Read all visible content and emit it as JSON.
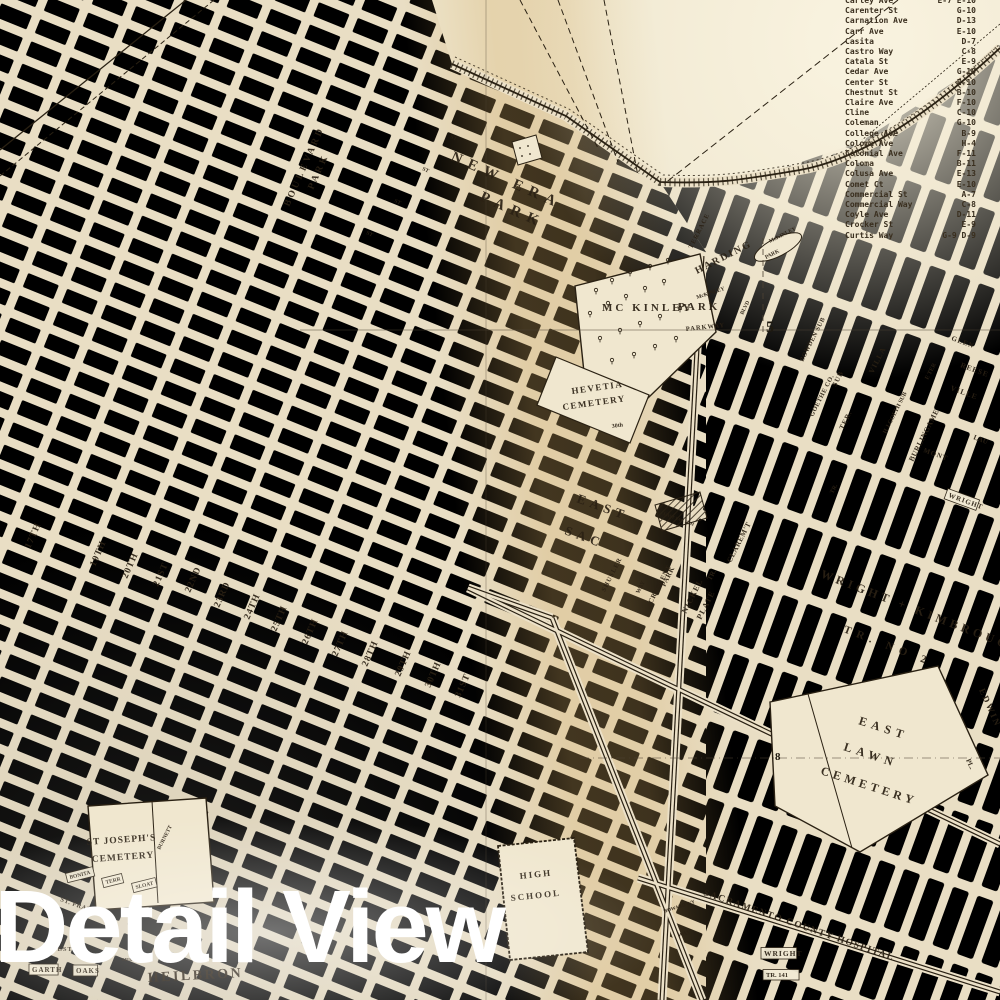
{
  "watermark": "Detail View",
  "street_index": {
    "rows": [
      {
        "name": "Carley Ave",
        "ref": "E-7 E-10"
      },
      {
        "name": "Carenter St",
        "ref": "G-10"
      },
      {
        "name": "Carnation Ave",
        "ref": "D-13"
      },
      {
        "name": "Carr Ave",
        "ref": "E-10"
      },
      {
        "name": "Casita",
        "ref": "D-7"
      },
      {
        "name": "Castro Way",
        "ref": "C-8"
      },
      {
        "name": "Catala St",
        "ref": "E-9"
      },
      {
        "name": "Cedar Ave",
        "ref": "G-10"
      },
      {
        "name": "Center St",
        "ref": "E-10"
      },
      {
        "name": "Chestnut St",
        "ref": "B-10"
      },
      {
        "name": "Claire Ave",
        "ref": "F-10"
      },
      {
        "name": "Cline",
        "ref": "C-10"
      },
      {
        "name": "Coleman",
        "ref": "G-10"
      },
      {
        "name": "College Ave",
        "ref": "B-9"
      },
      {
        "name": "Coloma Ave",
        "ref": "H-4"
      },
      {
        "name": "Colonial Ave",
        "ref": "F-11"
      },
      {
        "name": "Coloma",
        "ref": "B-11"
      },
      {
        "name": "Colusa Ave",
        "ref": "E-13"
      },
      {
        "name": "Comet Ct",
        "ref": "E-10"
      },
      {
        "name": "Commercial St",
        "ref": "A-7"
      },
      {
        "name": "Commercial Way",
        "ref": "C-8"
      },
      {
        "name": "Coyle Ave",
        "ref": "D-11"
      },
      {
        "name": "Crocker St",
        "ref": "E-9"
      },
      {
        "name": "Curtis Way",
        "ref": "G-9 D-9"
      }
    ]
  },
  "map": {
    "labels": [
      [
        "NEW ERA",
        450,
        160,
        24,
        15,
        7
      ],
      [
        "PARK",
        479,
        200,
        24,
        15,
        7
      ],
      [
        "BOULEVARD",
        289,
        207,
        -66,
        9.5,
        3
      ],
      [
        "PARK",
        313,
        190,
        -66,
        9.5,
        3
      ],
      [
        "MC KINLEY",
        602,
        311,
        0,
        11,
        3
      ],
      [
        "PARK",
        678,
        310,
        0,
        11,
        3
      ],
      [
        "HARDING",
        697,
        274,
        -27,
        10,
        2
      ],
      [
        "TERRACE",
        692,
        249,
        -63,
        6.5,
        1
      ],
      [
        "PARKWAY",
        686,
        331,
        -6,
        6.5,
        1
      ],
      [
        "McKINLEY",
        697,
        299,
        -18,
        5.5,
        0
      ],
      [
        "BLVD",
        743,
        315,
        -63,
        5.5,
        0
      ],
      [
        "McKINLEY",
        770,
        243,
        -27,
        5.5,
        0
      ],
      [
        "PARK",
        766,
        259,
        -27,
        5.5,
        0
      ],
      [
        "HEVETIA",
        572,
        394,
        -8,
        9,
        1.5
      ],
      [
        "CEMETERY",
        563,
        410,
        -8,
        9,
        1.5
      ],
      [
        "EAST",
        576,
        502,
        20,
        13,
        5
      ],
      [
        "SAC",
        564,
        534,
        20,
        13,
        5
      ],
      [
        "SHUSLER",
        605,
        592,
        -63,
        6.5,
        1
      ],
      [
        "WAY",
        639,
        594,
        -63,
        6,
        0
      ],
      [
        "CRESCENT",
        652,
        604,
        -63,
        7,
        0.5
      ],
      [
        "PARK",
        665,
        587,
        -63,
        7,
        0.5
      ],
      [
        "NICKEL",
        686,
        614,
        -63,
        8,
        1
      ],
      [
        "PLATE",
        701,
        620,
        -63,
        8,
        1
      ],
      [
        "TR.",
        711,
        581,
        -63,
        7,
        0
      ],
      [
        "CLAREM'T",
        731,
        563,
        -63,
        7.5,
        0.5
      ],
      [
        "EAST",
        858,
        724,
        18,
        12,
        5
      ],
      [
        "LAWN",
        843,
        750,
        18,
        12,
        5
      ],
      [
        "CEMETERY",
        820,
        774,
        18,
        12,
        4
      ],
      [
        "EDWIN",
        979,
        690,
        66,
        9,
        2
      ],
      [
        "PL.",
        966,
        760,
        66,
        7,
        0
      ],
      [
        "SACRAMENTO COUNTY HOSPITAL",
        703,
        895,
        19,
        9.5,
        1.5
      ],
      [
        "WRIGHT + KIMBROUGH",
        820,
        577,
        21,
        12,
        4
      ],
      [
        "TR. NO 2",
        843,
        632,
        21,
        11,
        6
      ],
      [
        "WRIGHT",
        948,
        497,
        20,
        7,
        1,
        1
      ],
      [
        "TR.",
        833,
        494,
        -63,
        6,
        0
      ],
      [
        "BOWDEN SUB",
        803,
        362,
        -63,
        6.5,
        0.5
      ],
      [
        "GOETHE CO.",
        813,
        417,
        -63,
        6.5,
        0.5
      ],
      [
        "SUB",
        836,
        387,
        -63,
        7,
        1
      ],
      [
        "TER.",
        843,
        430,
        -63,
        7,
        1
      ],
      [
        "VILLA",
        873,
        374,
        -63,
        7.5,
        1
      ],
      [
        "H.J.GOETH SUB",
        886,
        434,
        -63,
        6,
        0
      ],
      [
        "BURLINGAME",
        913,
        462,
        -63,
        7.5,
        0.5
      ],
      [
        "E TER",
        928,
        380,
        -63,
        6,
        0
      ],
      [
        "GLEN",
        951,
        340,
        20,
        7,
        1
      ],
      [
        "REESE",
        960,
        367,
        20,
        7.5,
        1
      ],
      [
        "VILLE",
        950,
        390,
        20,
        7.5,
        1
      ],
      [
        "MONT",
        923,
        452,
        20,
        7,
        1
      ],
      [
        "LAU",
        973,
        439,
        20,
        7,
        0
      ],
      [
        "ST JOSEPH'S",
        87,
        845,
        -4,
        9.5,
        1
      ],
      [
        "CEMETERY",
        92,
        862,
        -4,
        9.5,
        1
      ],
      [
        "BONITA",
        70,
        879,
        -14,
        5.5,
        0,
        1
      ],
      [
        "TERR",
        106,
        884,
        -14,
        5.5,
        0,
        1
      ],
      [
        "SLOAT",
        136,
        889,
        -14,
        5.5,
        0,
        1
      ],
      [
        "BURNETT",
        160,
        850,
        -63,
        5.5,
        0
      ],
      [
        "HIGH",
        520,
        879,
        -6,
        9,
        2
      ],
      [
        "SCHOOL",
        511,
        901,
        -6,
        9,
        2
      ],
      [
        "ST. FRANCIS",
        60,
        901,
        20,
        6.5,
        0.5
      ],
      [
        "WEST",
        50,
        951,
        0,
        6.5,
        1
      ],
      [
        "GARTH",
        32,
        972,
        0,
        7,
        1,
        1
      ],
      [
        "OAKS",
        76,
        973,
        0,
        7,
        1,
        1
      ],
      [
        "SIERRA SCH",
        122,
        961,
        0,
        4.5,
        0
      ],
      [
        "HEILBRON",
        148,
        982,
        -3,
        14,
        2.5
      ],
      [
        "WRIGHT",
        764,
        956,
        0,
        7.5,
        1,
        1
      ],
      [
        "TR. 141",
        766,
        977,
        0,
        6.5,
        0,
        1
      ],
      [
        "HOWARD WY",
        664,
        913,
        -18,
        5,
        0
      ],
      [
        "WAY",
        678,
        937,
        -14,
        6,
        0
      ],
      [
        "EAST SAC SCH",
        663,
        515,
        20,
        4.5,
        0
      ],
      [
        "17TH",
        30,
        549,
        -66,
        9.5,
        1
      ],
      [
        "19TH",
        95,
        567,
        -66,
        9.5,
        1
      ],
      [
        "20TH",
        127,
        579,
        -66,
        9.5,
        1
      ],
      [
        "21ST",
        158,
        587,
        -66,
        9.5,
        1
      ],
      [
        "22ND",
        190,
        593,
        -66,
        9.5,
        1
      ],
      [
        "23RD",
        219,
        608,
        -66,
        9.5,
        1
      ],
      [
        "24TH",
        249,
        620,
        -66,
        9.5,
        1
      ],
      [
        "25TH",
        276,
        632,
        -66,
        9.5,
        1
      ],
      [
        "26TH",
        307,
        645,
        -66,
        9.5,
        1
      ],
      [
        "27TH",
        337,
        657,
        -66,
        9.5,
        1
      ],
      [
        "28TH",
        367,
        667,
        -66,
        9.5,
        1
      ],
      [
        "29TH",
        400,
        677,
        -66,
        9.5,
        1
      ],
      [
        "30TH",
        430,
        688,
        -66,
        9.5,
        1
      ],
      [
        "31ST",
        460,
        698,
        -66,
        9.5,
        1
      ],
      [
        "ST",
        450,
        138,
        24,
        5.5,
        0
      ],
      [
        "ST",
        422,
        170,
        24,
        5.5,
        0
      ],
      [
        "ST",
        394,
        202,
        24,
        5.5,
        0
      ],
      [
        "ST",
        366,
        234,
        24,
        5.5,
        0
      ],
      [
        "30th",
        612,
        428,
        -8,
        6,
        0
      ]
    ],
    "grid_numbers": [
      {
        "text": "5",
        "x": 766,
        "y": 332,
        "size": 16
      },
      {
        "text": "8",
        "x": 775,
        "y": 760,
        "size": 11
      }
    ]
  }
}
